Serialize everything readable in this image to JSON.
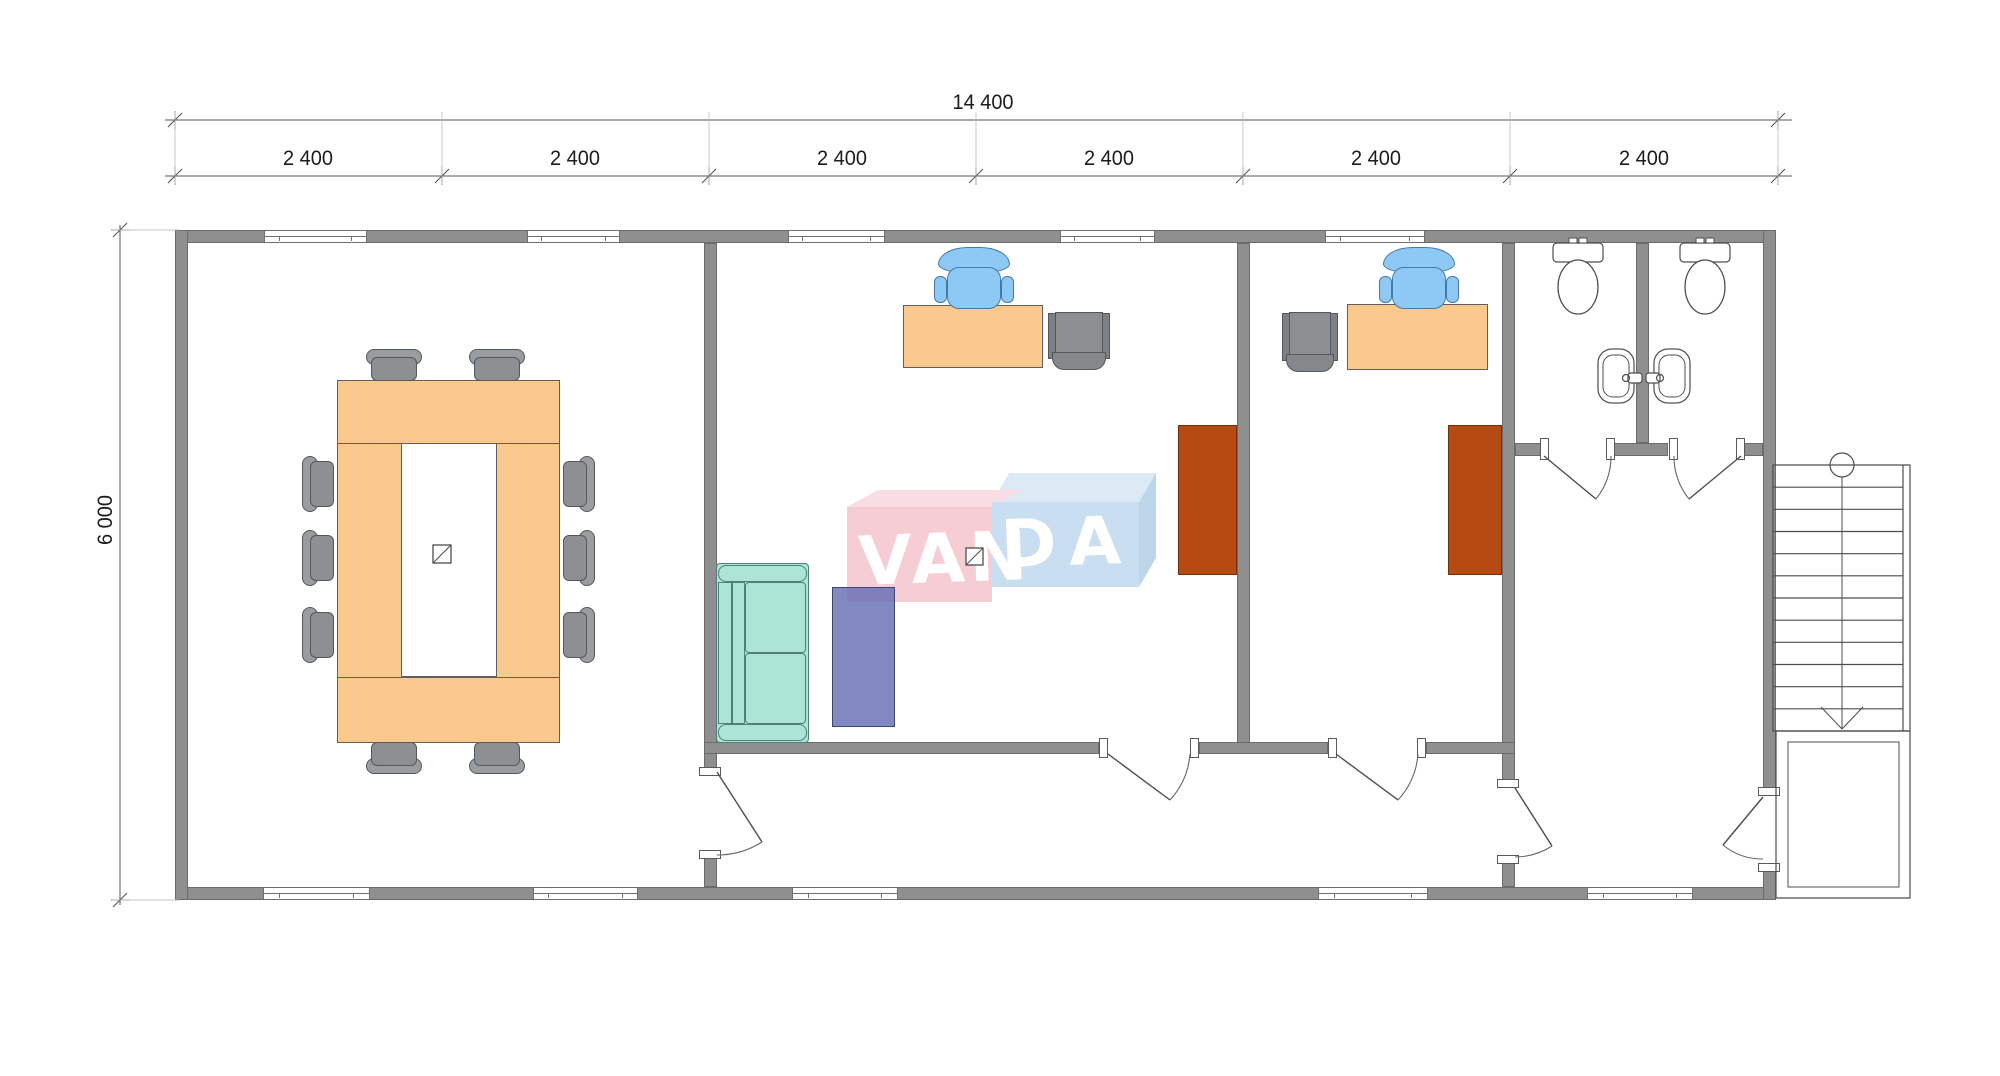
{
  "title": "office-floor-plan",
  "watermark": {
    "brand_full": "VANDA",
    "text_left": "VAN",
    "text_right": "DA",
    "pink_front": "#f6ccd5",
    "pink_top": "#f8dde3",
    "blue_front": "#c9def0",
    "blue_top": "#dceaf6",
    "blue_side": "#bdd6ea"
  },
  "dimensions": {
    "total_width_label": "14 400",
    "height_label": "6 000",
    "segment_labels": [
      "2 400",
      "2 400",
      "2 400",
      "2 400",
      "2 400",
      "2 400"
    ],
    "segment_label_centers_x": [
      308,
      575,
      842,
      1109,
      1376,
      1644
    ],
    "top_line1_y": 120,
    "top_line2_y": 176,
    "line_x1": 165,
    "line_x2": 1792,
    "tick_xs": [
      175,
      442,
      709,
      976,
      1243,
      1510,
      1778
    ],
    "left_line_x": 120,
    "left_line_y1": 225,
    "left_line_y2": 905,
    "left_tick_ys": [
      230,
      900
    ],
    "total_label_pos": [
      983,
      103
    ],
    "segment_label_y": 159,
    "height_label_pos": [
      106,
      520
    ]
  },
  "plan": {
    "wall_color": "#8f8f8f",
    "walls": [
      [
        175,
        230,
        1601,
        13
      ],
      [
        175,
        887,
        1601,
        13
      ],
      [
        175,
        230,
        13,
        670
      ],
      [
        1763,
        230,
        13,
        562
      ],
      [
        1763,
        868,
        13,
        32
      ],
      [
        704,
        243,
        13,
        529
      ],
      [
        704,
        855,
        13,
        32
      ],
      [
        1237,
        243,
        13,
        511
      ],
      [
        1502,
        243,
        13,
        545
      ],
      [
        1502,
        860,
        13,
        27
      ],
      [
        704,
        742,
        395,
        12
      ],
      [
        1199,
        742,
        129,
        12
      ],
      [
        1426,
        742,
        89,
        12
      ],
      [
        1515,
        443,
        29,
        13
      ],
      [
        1611,
        443,
        57,
        13
      ],
      [
        1741,
        443,
        22,
        13
      ],
      [
        1636,
        243,
        13,
        200
      ]
    ],
    "windows": [
      [
        264,
        230,
        103,
        13
      ],
      [
        527,
        230,
        93,
        13
      ],
      [
        788,
        230,
        97,
        13
      ],
      [
        1060,
        230,
        95,
        13
      ],
      [
        1325,
        230,
        100,
        13
      ],
      [
        263,
        887,
        107,
        13
      ],
      [
        533,
        887,
        105,
        13
      ],
      [
        792,
        887,
        106,
        13
      ],
      [
        1318,
        887,
        110,
        13
      ],
      [
        1587,
        887,
        106,
        13
      ]
    ],
    "caps": [
      [
        1099,
        738,
        9,
        20
      ],
      [
        1190,
        738,
        9,
        20
      ],
      [
        1328,
        738,
        9,
        20
      ],
      [
        1417,
        738,
        9,
        20
      ],
      [
        699,
        767,
        22,
        9
      ],
      [
        699,
        850,
        22,
        9
      ],
      [
        1497,
        779,
        22,
        9
      ],
      [
        1497,
        855,
        22,
        9
      ],
      [
        1758,
        787,
        22,
        9
      ],
      [
        1758,
        863,
        22,
        9
      ],
      [
        1540,
        438,
        9,
        22
      ],
      [
        1606,
        438,
        9,
        22
      ],
      [
        1669,
        438,
        9,
        22
      ],
      [
        1736,
        438,
        9,
        22
      ]
    ],
    "doors": [
      {
        "name": "door-conference",
        "leaf": "M717,772 L762,842",
        "arc": "M762,842 A83,83 0 0 1 717,855"
      },
      {
        "name": "door-office-1",
        "leaf": "M1108,754 L1170,800",
        "arc": "M1170,800 A77,77 0 0 0 1190,754"
      },
      {
        "name": "door-office-2",
        "leaf": "M1336,754 L1398,800",
        "arc": "M1398,800 A77,77 0 0 0 1418,754"
      },
      {
        "name": "door-hall",
        "leaf": "M1515,788 L1552,846",
        "arc": "M1552,846 A69,69 0 0 1 1515,857"
      },
      {
        "name": "door-entry",
        "leaf": "M1763,797 L1723,845",
        "arc": "M1723,845 A62,62 0 0 0 1763,859"
      },
      {
        "name": "door-wc-left",
        "leaf": "M1544,456 L1596,499",
        "arc": "M1596,499 A67,67 0 0 0 1611,456"
      },
      {
        "name": "door-wc-right",
        "leaf": "M1741,456 L1689,499",
        "arc": "M1689,499 A67,67 0 0 1 1674,456"
      }
    ],
    "conference": {
      "table": [
        337,
        380,
        223,
        363
      ],
      "table_inner": [
        401,
        443,
        96,
        234
      ],
      "table_lines_y": [
        443,
        677
      ],
      "chairs_top": [
        [
          394,
          357
        ],
        [
          497,
          357
        ]
      ],
      "chairs_bottom": [
        [
          394,
          758
        ],
        [
          497,
          758
        ]
      ],
      "chairs_left": [
        [
          317,
          484
        ],
        [
          317,
          558
        ],
        [
          317,
          635
        ]
      ],
      "chairs_right": [
        [
          580,
          484
        ],
        [
          580,
          558
        ],
        [
          580,
          635
        ]
      ]
    },
    "office1": {
      "desk": [
        903,
        305,
        140,
        63
      ],
      "blue_chair_cx": 974,
      "blue_chair_top": 247,
      "gray_chair": [
        1048,
        312,
        62,
        58
      ],
      "cabinet": [
        1178,
        425,
        59,
        150
      ]
    },
    "office2": {
      "desk": [
        1347,
        304,
        141,
        66
      ],
      "blue_chair_cx": 1419,
      "blue_chair_top": 247,
      "gray_chair": [
        1282,
        312,
        56,
        60
      ],
      "cabinet": [
        1448,
        425,
        54,
        150
      ]
    },
    "couch": [
      716,
      563,
      93,
      180
    ],
    "purple_table": [
      832,
      587,
      63,
      140
    ],
    "symbols": [
      [
        433,
        545,
        18
      ],
      [
        966,
        548,
        17
      ]
    ],
    "toilets": [
      {
        "cx": 1578
      },
      {
        "cx": 1705
      }
    ],
    "sinks": {
      "left_x": 1598,
      "right_x": 1654,
      "y": 349,
      "w": 36,
      "h": 54
    },
    "stairs": {
      "x1": 1773,
      "y1": 465,
      "x2": 1910,
      "y2": 731,
      "inner_x": 1903,
      "treads": 11,
      "center_x": 1842,
      "circle_r": 12,
      "arrow": [
        [
          1821,
          707
        ],
        [
          1842,
          729
        ],
        [
          1863,
          707
        ]
      ]
    },
    "porch": {
      "outer": [
        1776,
        731,
        134,
        167
      ],
      "inner": [
        1788,
        742,
        111,
        145
      ]
    },
    "watermark_geo": {
      "pink_front": [
        847,
        507,
        145,
        95
      ],
      "pink_top": "847,507 878,490 1023,490 992,507",
      "blue_front": [
        992,
        502,
        147,
        85
      ],
      "blue_top": "992,502 1009,473 1156,473 1139,502",
      "blue_side": "1139,502 1156,473 1156,558 1139,587",
      "van_pos": [
        860,
        526
      ],
      "da_pos": [
        1002,
        510
      ]
    }
  }
}
